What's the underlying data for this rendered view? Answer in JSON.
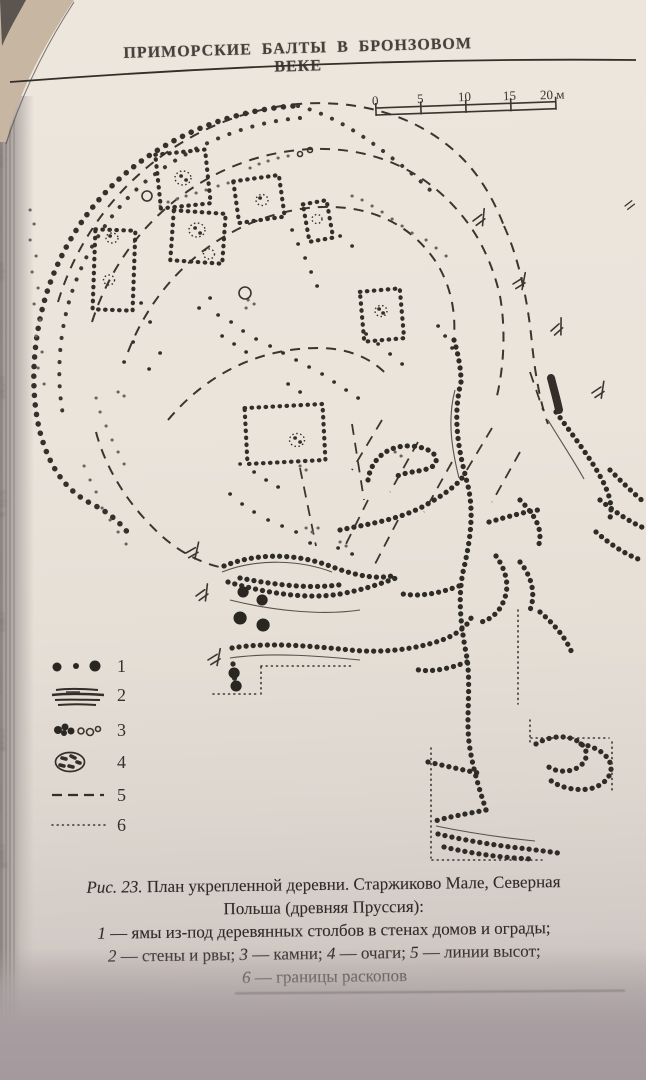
{
  "header": {
    "title": "ПРИМОРСКИЕ БАЛТЫ В БРОНЗОВОМ ВЕКЕ"
  },
  "scale": {
    "labels": [
      "0",
      "5",
      "10",
      "15",
      "20 м"
    ]
  },
  "legend": {
    "numbers": [
      "1",
      "2",
      "3",
      "4",
      "5",
      "6"
    ]
  },
  "caption": {
    "fig": "Рис. 23.",
    "line1": "План укрепленной деревни. Старжиково Мале, Северная",
    "line2": "Польша (древняя Пруссия):",
    "line3": {
      "num": "1",
      "text": "— ямы из-под деревянных столбов в стенах домов и ограды;"
    },
    "line4": [
      {
        "num": "2",
        "text": "— стены и рвы;"
      },
      {
        "num": "3",
        "text": "— камни;"
      },
      {
        "num": "4",
        "text": "— очаги;"
      },
      {
        "num": "5",
        "text": "— линии высот;"
      }
    ],
    "line5": {
      "num": "6",
      "text": "— границы раскопов"
    }
  },
  "gutter": {
    "fragments": [
      "гим",
      "е ум",
      "оро",
      "ами",
      "отве",
      "же, ка",
      "VII в",
      "над с",
      "смо",
      "окол",
      "став",
      "одна",
      "ской"
    ]
  },
  "colors": {
    "ink": "#332e29",
    "paper": "#ebe5dc",
    "paper_shadow": "#a89fa1",
    "corner_tan": "#c7b6a2"
  }
}
